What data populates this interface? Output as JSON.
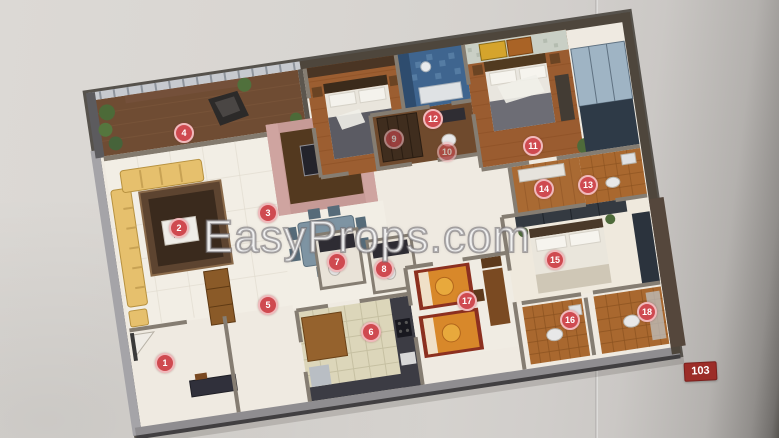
{
  "watermark": {
    "text": "EasyProps.com"
  },
  "unit_badge": {
    "label": "103"
  },
  "markers": [
    {
      "number": "1",
      "x": 165,
      "y": 363,
      "faded": false
    },
    {
      "number": "2",
      "x": 179,
      "y": 228,
      "faded": false
    },
    {
      "number": "3",
      "x": 268,
      "y": 213,
      "faded": false
    },
    {
      "number": "4",
      "x": 184,
      "y": 133,
      "faded": false
    },
    {
      "number": "5",
      "x": 268,
      "y": 305,
      "faded": false
    },
    {
      "number": "6",
      "x": 371,
      "y": 332,
      "faded": false
    },
    {
      "number": "7",
      "x": 337,
      "y": 262,
      "faded": false
    },
    {
      "number": "8",
      "x": 384,
      "y": 269,
      "faded": false
    },
    {
      "number": "9",
      "x": 394,
      "y": 139,
      "faded": true
    },
    {
      "number": "10",
      "x": 447,
      "y": 152,
      "faded": true
    },
    {
      "number": "11",
      "x": 533,
      "y": 146,
      "faded": false
    },
    {
      "number": "12",
      "x": 433,
      "y": 119,
      "faded": false
    },
    {
      "number": "13",
      "x": 588,
      "y": 185,
      "faded": false
    },
    {
      "number": "14",
      "x": 544,
      "y": 189,
      "faded": false
    },
    {
      "number": "15",
      "x": 555,
      "y": 260,
      "faded": false
    },
    {
      "number": "16",
      "x": 570,
      "y": 320,
      "faded": false
    },
    {
      "number": "17",
      "x": 467,
      "y": 301,
      "faded": false
    },
    {
      "number": "18",
      "x": 647,
      "y": 312,
      "faded": false
    }
  ],
  "features": [
    "terrace",
    "living-room",
    "tv-unit",
    "dining-area",
    "foyer",
    "kitchen",
    "bedroom-2",
    "bathroom-blue",
    "dressing-area",
    "master-bedroom",
    "wardrobe",
    "bedroom-3",
    "kids-bedroom",
    "bathroom",
    "bathroom-2"
  ],
  "colors": {
    "page_bg": "#d8d5d1",
    "marker_fill": "#cf4a50",
    "marker_ring": "#f0b9bb",
    "marker_text": "#ffffff",
    "badge_bg": "#9c2d28",
    "badge_text": "#ffffff",
    "wall_dark": "#4e463c",
    "wall_light": "#969499",
    "floor_cream": "#f1ede4",
    "floor_wood": "#9a5c30",
    "floor_tile_bath": "#a9682f",
    "floor_kitchen": "#dcd6ba",
    "terrace_floor": "#6f4c33",
    "sofa_yellow": "#e6c06d",
    "tv_wall_pink": "#c69a96",
    "bath_blue": "#3f658f",
    "kids_bed_orange": "#d8882a"
  }
}
